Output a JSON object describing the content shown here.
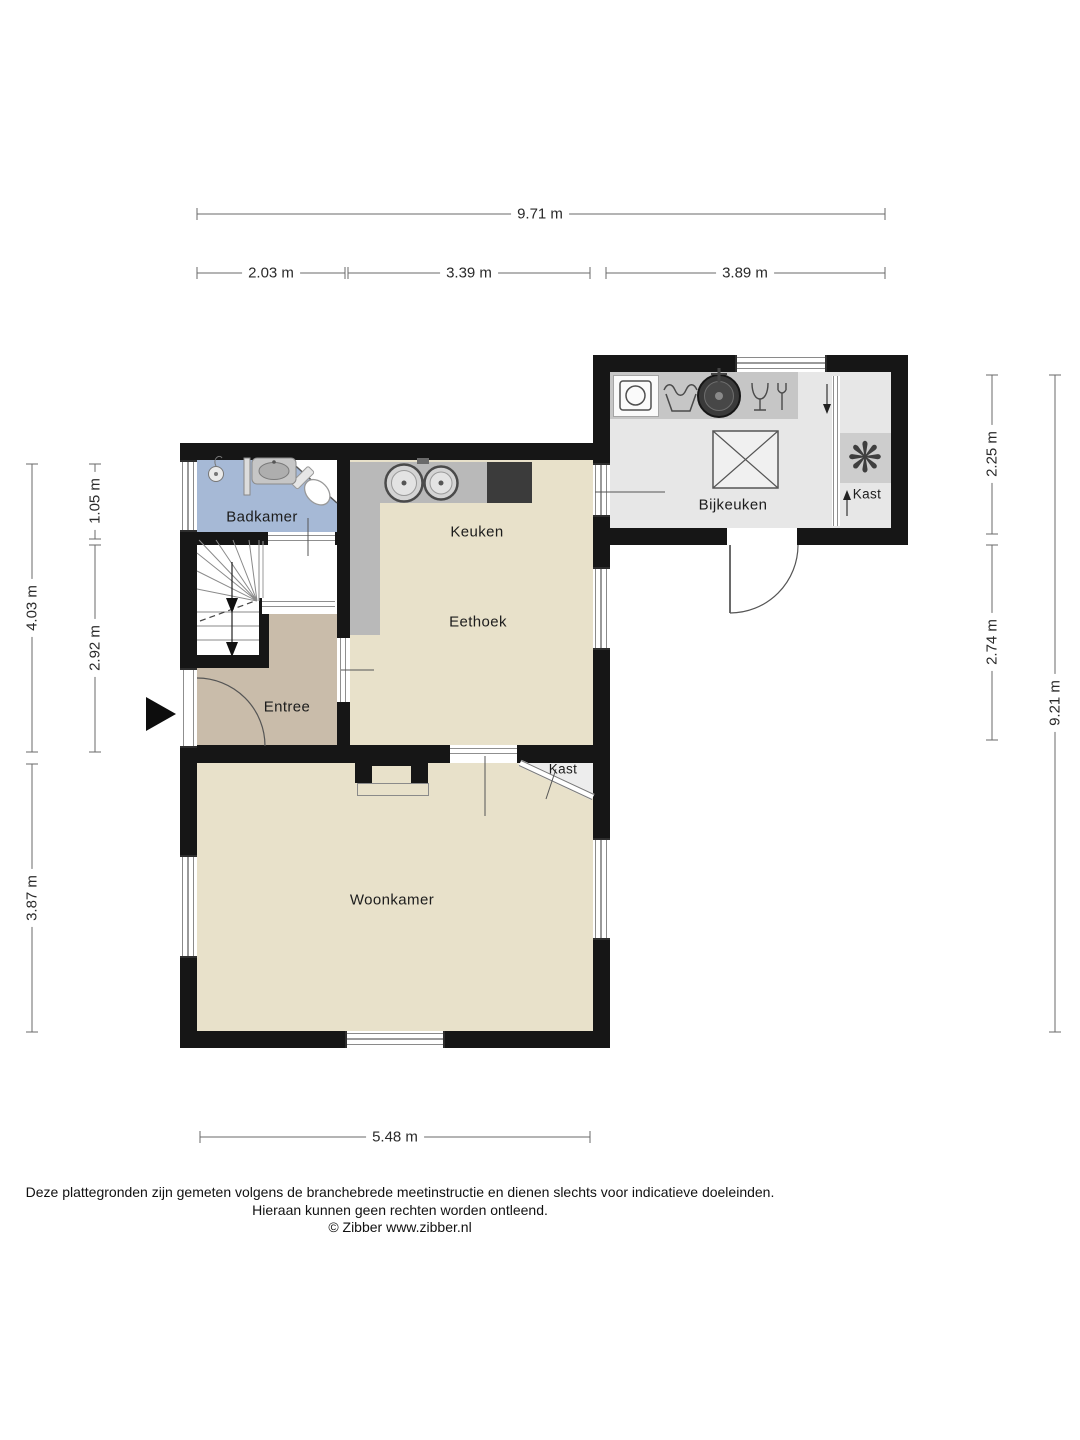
{
  "rooms": {
    "badkamer": "Badkamer",
    "keuken": "Keuken",
    "eethoek": "Eethoek",
    "entree": "Entree",
    "bijkeuken": "Bijkeuken",
    "kast_bijkeuken": "Kast",
    "kast_woonkamer": "Kast",
    "woonkamer": "Woonkamer"
  },
  "dimensions": {
    "top_total": "9.71 m",
    "top_seg1": "2.03 m",
    "top_seg2": "3.39 m",
    "top_seg3": "3.89 m",
    "left_outer_top": "4.03 m",
    "left_outer_bottom": "3.87 m",
    "left_inner_top": "1.05 m",
    "left_inner_bottom": "2.92 m",
    "right_inner_top": "2.25 m",
    "right_inner_bottom": "2.74 m",
    "right_outer": "9.21 m",
    "bottom": "5.48 m"
  },
  "icons": {
    "fan_glyph": "❋"
  },
  "footer": {
    "line1": "Deze plattegronden zijn gemeten volgens de branchebrede meetinstructie en dienen slechts voor indicatieve doeleinden.",
    "line2": "Hieraan kunnen geen rechten worden ontleend.",
    "line3": "© Zibber www.zibber.nl"
  },
  "colors": {
    "wall": "#161616",
    "floor_living": "#e8e1ca",
    "floor_entry": "#c9bcaa",
    "floor_bath": "#a6b9d6",
    "floor_utility": "#e7e7e7",
    "counter_kitchen": "#b9b9b9",
    "counter_utility": "#c6c6c6",
    "cooktop": "#3b3b3b"
  }
}
